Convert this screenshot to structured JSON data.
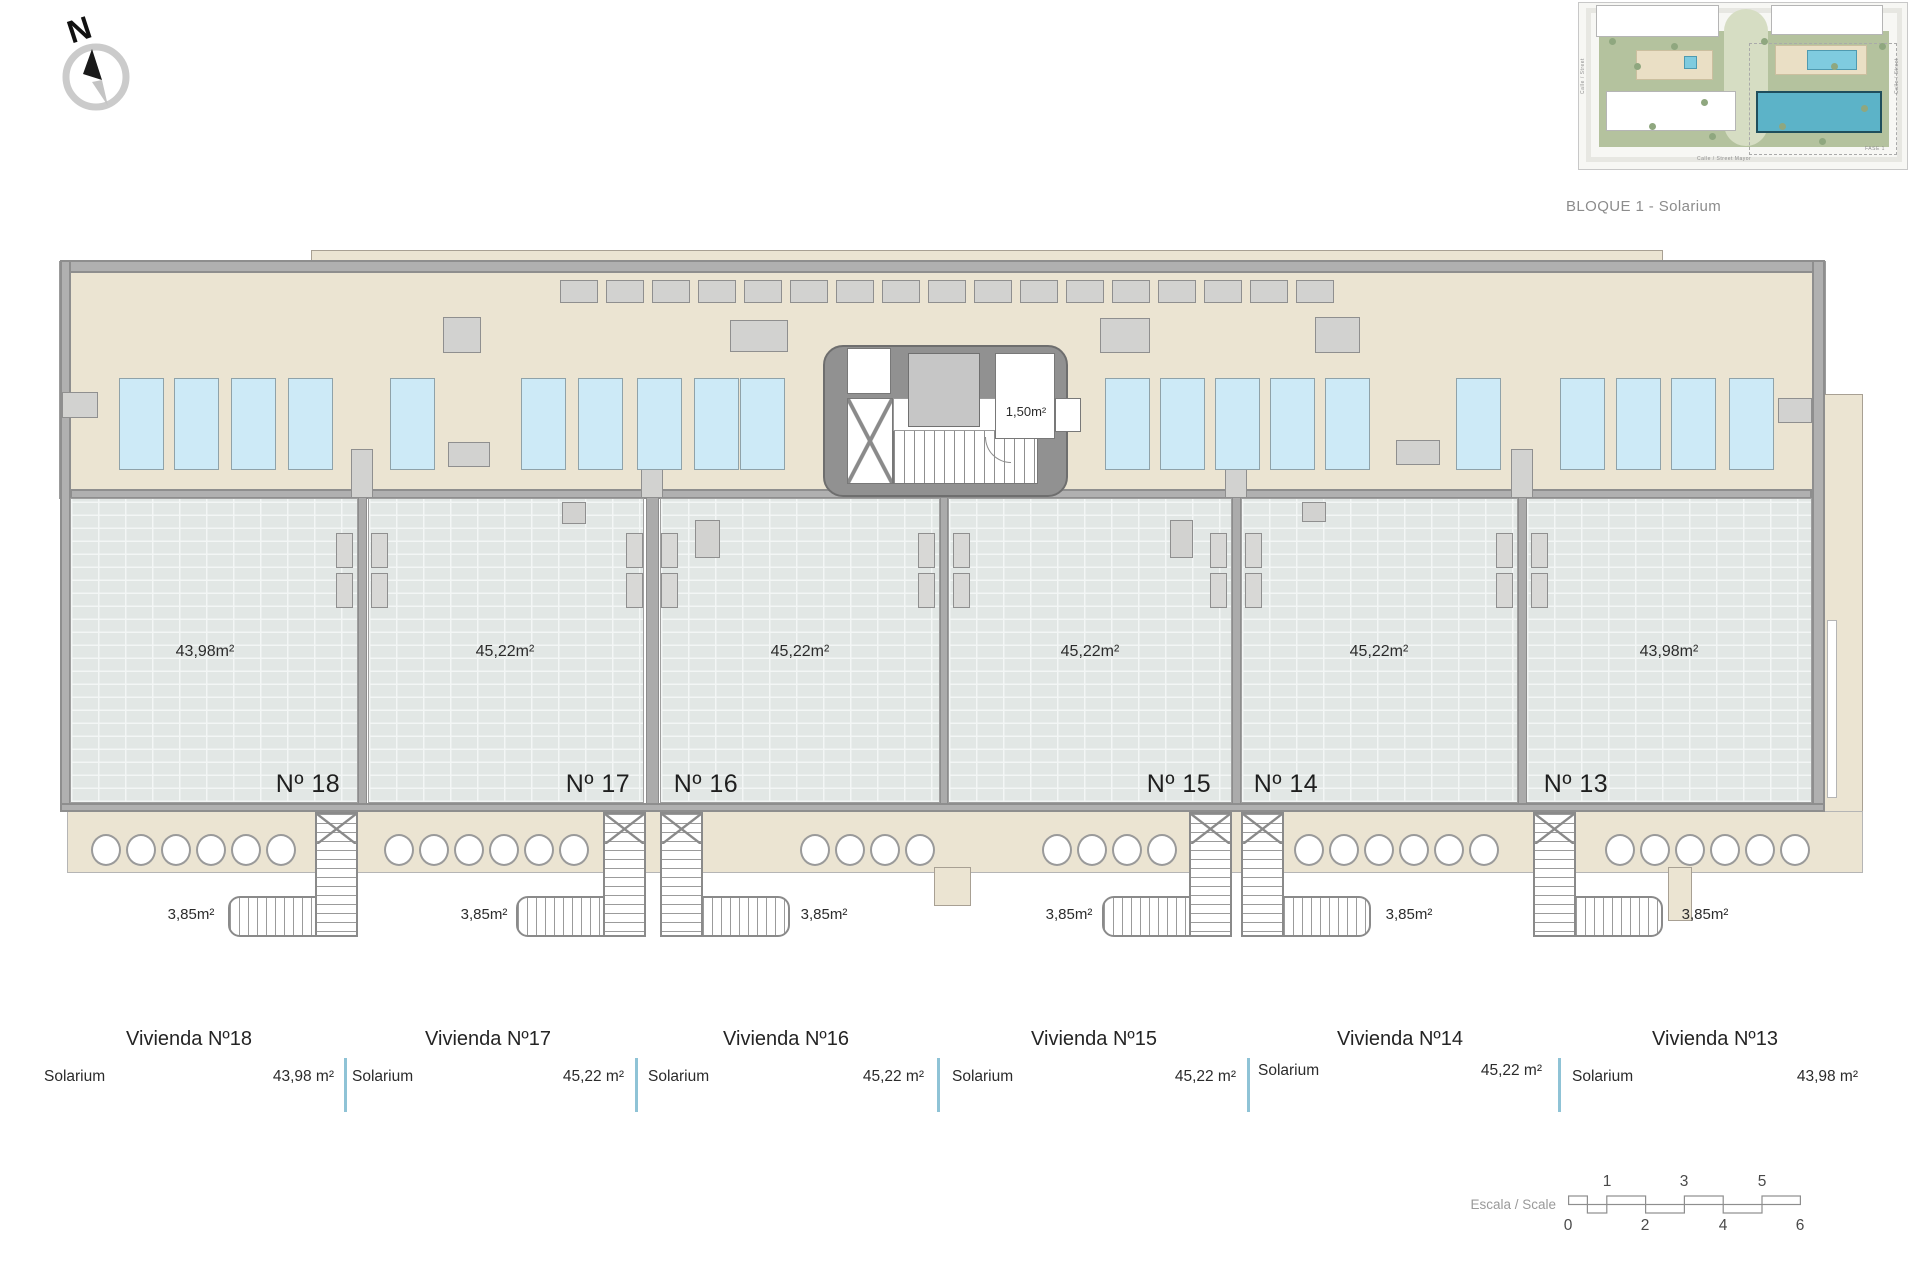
{
  "header": {
    "caption": "BLOQUE 1 - Solarium",
    "compass_letter": "N"
  },
  "site_plan": {
    "street_bottom": "Calle / Street Mayor",
    "street_left": "Calle / Street",
    "street_right": "Calle / Street",
    "phase_label": "FASE 1"
  },
  "core": {
    "room_area": "1,50m²"
  },
  "units": [
    {
      "number": "Nº 18",
      "area": "43,98m²",
      "stair_area": "3,85m²"
    },
    {
      "number": "Nº 17",
      "area": "45,22m²",
      "stair_area": "3,85m²"
    },
    {
      "number": "Nº 16",
      "area": "45,22m²",
      "stair_area": "3,85m²"
    },
    {
      "number": "Nº 15",
      "area": "45,22m²",
      "stair_area": "3,85m²"
    },
    {
      "number": "Nº 14",
      "area": "45,22m²",
      "stair_area": "3,85m²"
    },
    {
      "number": "Nº 13",
      "area": "43,98m²",
      "stair_area": "3,85m²"
    }
  ],
  "legend": {
    "columns": [
      {
        "title": "Vivienda Nº18",
        "row_label": "Solarium",
        "row_value": "43,98 m²"
      },
      {
        "title": "Vivienda Nº17",
        "row_label": "Solarium",
        "row_value": "45,22 m²"
      },
      {
        "title": "Vivienda Nº16",
        "row_label": "Solarium",
        "row_value": "45,22 m²"
      },
      {
        "title": "Vivienda Nº15",
        "row_label": "Solarium",
        "row_value": "45,22 m²"
      },
      {
        "title": "Vivienda Nº14",
        "row_label": "Solarium",
        "row_value": "45,22 m²"
      },
      {
        "title": "Vivienda Nº13",
        "row_label": "Solarium",
        "row_value": "43,98 m²"
      }
    ]
  },
  "scale_bar": {
    "label": "Escala / Scale",
    "top_ticks": [
      "1",
      "3",
      "5"
    ],
    "bottom_ticks": [
      "0",
      "2",
      "4",
      "6"
    ]
  },
  "colors": {
    "deck_beige": "#ebe4d2",
    "panel_blue": "#cdeaf7",
    "legend_separator": "#8fc3d6",
    "site_highlight_teal": "#5cb3c8"
  }
}
